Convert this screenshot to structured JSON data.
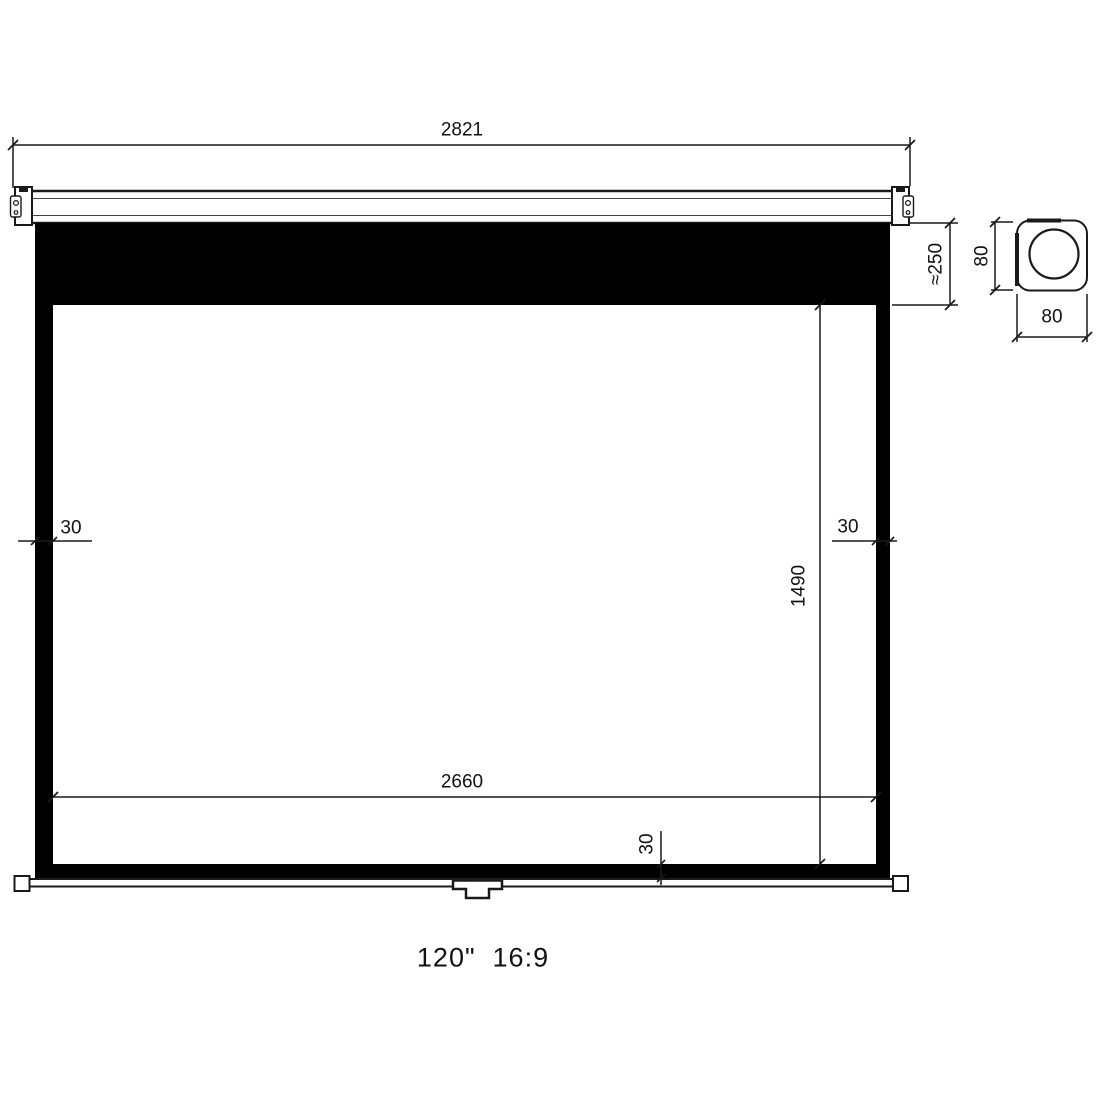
{
  "drawing": {
    "caption": "120\"  16:9",
    "dims": {
      "case_width": "2821",
      "top_black_drop": "≈250",
      "left_border": "30",
      "right_border": "30",
      "screen_height": "1490",
      "screen_width": "2660",
      "bottom_border": "30",
      "case_section_height": "80",
      "case_section_width": "80"
    },
    "colors": {
      "line": "#1a1a1a",
      "black_fill": "#000000",
      "background": "#ffffff"
    }
  }
}
